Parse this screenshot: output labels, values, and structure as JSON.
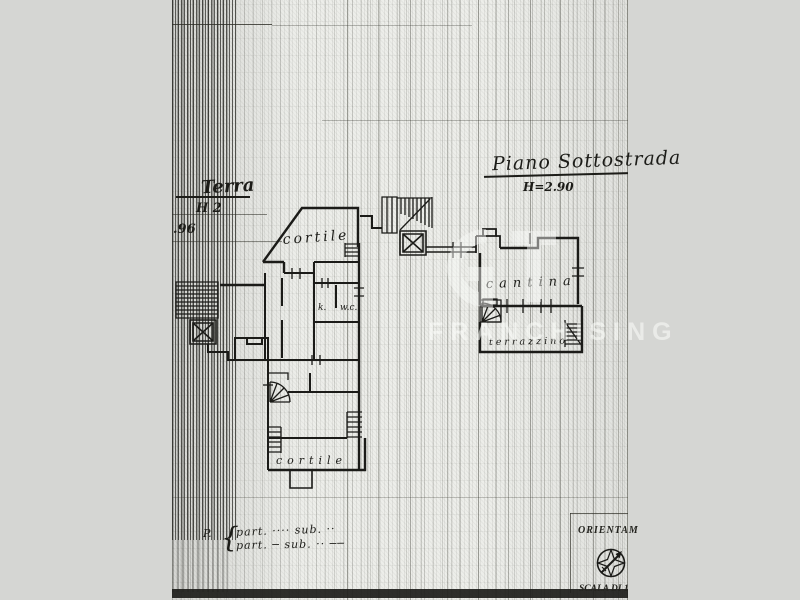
{
  "photo": {
    "background_color": "#d5d6d3",
    "paper_color": "#edeeea",
    "ink_color": "#1b1b18"
  },
  "plan_titles": {
    "basement": {
      "title": "Piano Sottostrada",
      "height": "H=2.90"
    },
    "ground": {
      "title": "Terra",
      "height_top": "H 2",
      "height_bottom": ".96"
    }
  },
  "room_labels": {
    "ground_floor": {
      "courtyard_upper": "cortile",
      "kitchen": "k.",
      "wc": "w.c.",
      "courtyard_lower": "cortile"
    },
    "basement": {
      "cellar": "cantina",
      "terrace": "terrazzino"
    }
  },
  "cadastral_notes": {
    "prefix": "P.",
    "brace": "{",
    "row1": "part. ···· sub. ··",
    "row2": "part. ─ sub. ·· ──"
  },
  "legend": {
    "orientation_label": "ORIENTAM",
    "scale_label": "SCALA DI 1"
  },
  "watermark": {
    "text": "FRANCHISING"
  }
}
